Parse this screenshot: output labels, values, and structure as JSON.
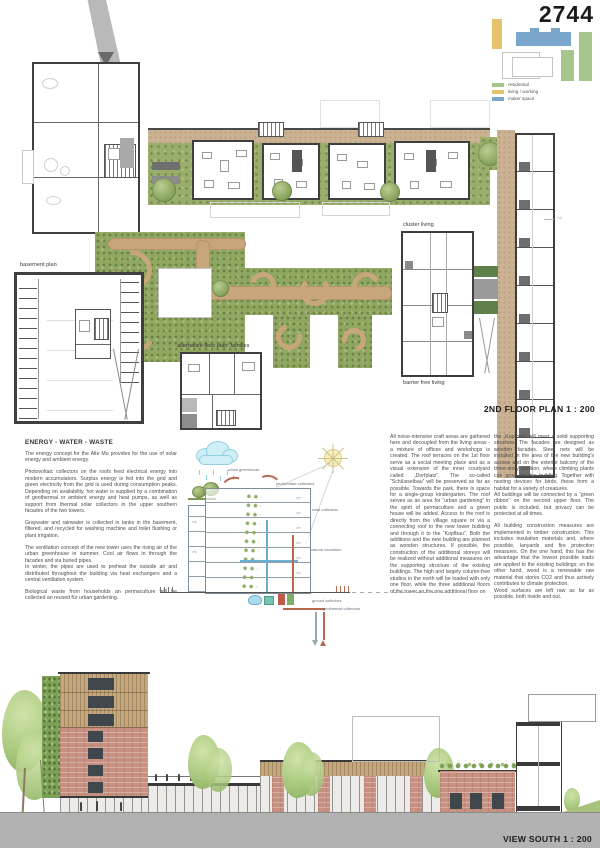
{
  "board": {
    "entry_number": "2744",
    "plan_title": "2ND FLOOR PLAN 1 : 200",
    "view_title": "VIEW SOUTH 1 : 200"
  },
  "site_key": {
    "legend": [
      {
        "label": "residential",
        "color": "#a6c68c"
      },
      {
        "label": "living / working",
        "color": "#e5c46d"
      },
      {
        "label": "maker space",
        "color": "#7ba6cb"
      }
    ]
  },
  "plan_labels": {
    "basement": "basement plan",
    "alternative": "alternative floor plan: families",
    "cluster": "cluster living",
    "barrier_free": "barrier free living",
    "street": "Str."
  },
  "energy_text": {
    "heading": "ENERGY - WATER - WASTE",
    "col1": [
      "The energy concept for the Alte Mu provides for the use of solar energy and ambient energy.",
      "Photovoltaic collectors on the roofs feed electrical energy into modern accumulators. Surplus energy is fed into the grid and green electricity from the grid is used during consumption peaks. Depending on availability, hot water is supplied by a combination of geothermal or ambient energy and heat pumps, as well as support from thermal solar collectors in the upper southern facades of the two towers.",
      "Graywater and rainwater is collected in tanks in the basement, filtered, and recycled for washing machine and toilet flushing or plant irrigation.",
      "The ventilation concept of the new tower uses the rising air of the urban greenhouse in summer. Cool air flows in through the facades and via buried pipes.\nIn winter, the pipes are used to preheat the outside air and distributed throughout the building via heat exchangers and a central ventilation system.",
      "Biological waste from households an permaculture will be collected an reused für urban gardening."
    ],
    "col2": [
      "All noise-intensive craft areas are gathered here and decoupled from the living areas - a mixture of offices and workshops is created. The roof terraces on the 1st floor serve as a social meeting place and as a visual extension of the inner courtyard called „Dorfplatz“. The so-called “Schlüsselbau” will be preserved as far as possible. Towards the park, there is space for a single-group kindergarten. The roof serves as an area for “urban gardening” in the spirit of permaculture and a green house will be added. Access to the roof is directly from the village square or via a connecting roof to the new tower building and through it to the “Kopfbau”. Both the additions and the new building are planned as wooden structures. If possible, the construction of the additional storeys will be realized without additional measures on the supporting structure of the existing buildings. The high and largely column-free studios in the north will be loaded with only one floor, while the three additional floors of the tower an the one additional floor on"
    ],
    "col3": [
      "the „Kopfbau“ will meet a solid supporting structure. The facades are designed as wooden facades. Steel nets will be installed in the area of the new building's access and on the exterior balcony of the three-story addition, where climbing plants can grow on the building. Together with nesting devices for birds, these form a habitat for a variety of creatures.\nAll buildings will be connected by a “green ribbon” on the second upper floor. The public is included, but privacy can be protected at all times.",
      "All building construction measures are implemented in timber construction. This includes insulation materials and, where possible, lanyards and fire protection measures. On the one hand, this has the advantage that the lowest possible loads are applied to the existing buildings; on the other hand, wood is a renewable raw material that stores CO2 and thus actively contributes to climate protection.\nWood surfaces are left raw as far as possible, both inside and out."
    ]
  },
  "diagram": {
    "labels": [
      "urban greenhouse",
      "photovoltaic collectors",
      "solar collectors",
      "natural circulation",
      "ground collectors",
      "geothermal collectors"
    ]
  },
  "colors": {
    "corridor_tan": "#cbb292",
    "garden_green": "#93aa64",
    "wall_dark": "#3f3f3f",
    "brick": "#c79182",
    "wood": "#c3a87e",
    "ground_gray": "#b2b2b2"
  }
}
